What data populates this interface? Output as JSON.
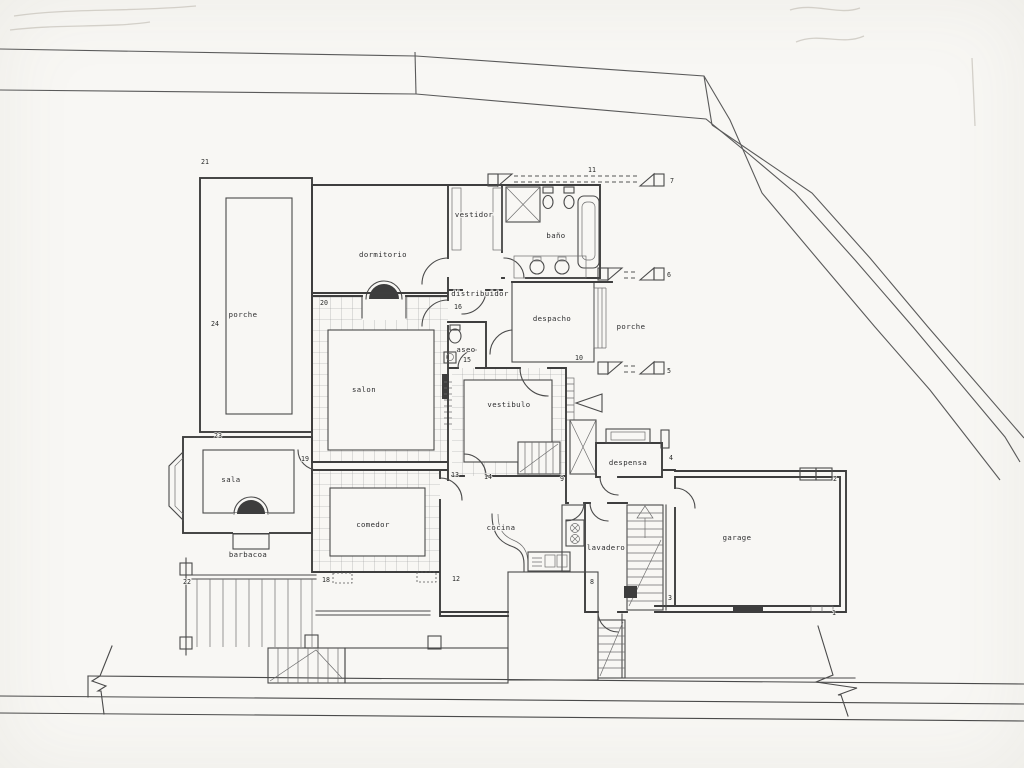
{
  "drawing": {
    "kind": "house floor plan (scanned pencil drawing)"
  },
  "colors": {
    "paper": "#f8f7f4",
    "ink": "#3e3e3e"
  },
  "rooms": {
    "vestidor": "vestidor",
    "bano": "baño",
    "dormitorio": "dormitorio",
    "distribuidor": "distribuidor",
    "despacho": "despacho",
    "porche_right": "porche",
    "aseo": "aseo",
    "salon": "salon",
    "vestibulo": "vestibulo",
    "despensa": "despensa",
    "comedor": "comedor",
    "cocina": "cocina",
    "lavadero": "lavadero",
    "garage": "garage",
    "sala": "sala",
    "porche_left": "porche",
    "barbacoa": "barbacoa"
  },
  "markers": {
    "m1": "1",
    "m2": "2",
    "m3": "3",
    "m4": "4",
    "m5": "5",
    "m6": "6",
    "m7": "7",
    "m8": "8",
    "m9": "9",
    "m10": "10",
    "m11": "11",
    "m12": "12",
    "m13": "13",
    "m14": "14",
    "m15": "15",
    "m16": "16",
    "m18": "18",
    "m19": "19",
    "m20": "20",
    "m21": "21",
    "m22": "22",
    "m23": "23",
    "m24": "24"
  }
}
